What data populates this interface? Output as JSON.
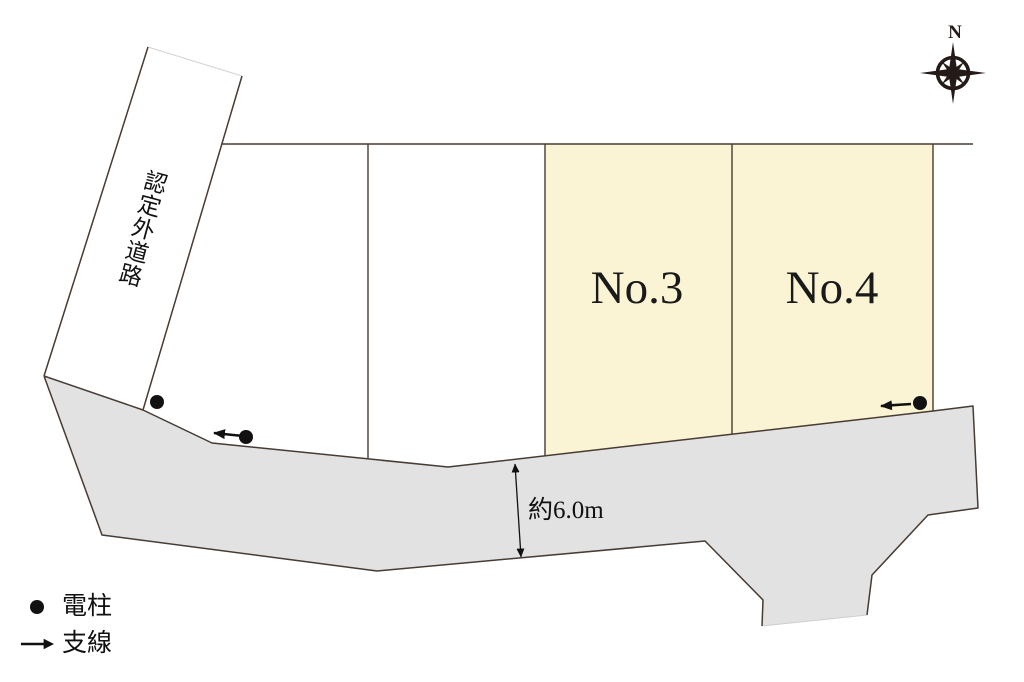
{
  "compass": {
    "label": "N"
  },
  "road_band": {
    "label": "認定外道路"
  },
  "lots": [
    {
      "label": "No.3"
    },
    {
      "label": "No.4"
    }
  ],
  "front_road": {
    "width_label": "約6.0m"
  },
  "legend": {
    "items": [
      {
        "icon": "utility-pole-dot",
        "label": "電柱"
      },
      {
        "icon": "guy-wire-arrow",
        "label": "支線"
      }
    ]
  },
  "colors": {
    "lot_fill": "#FBF4D4",
    "road_fill": "#E2E2E2",
    "line": "#473B33",
    "ink": "#111111"
  }
}
